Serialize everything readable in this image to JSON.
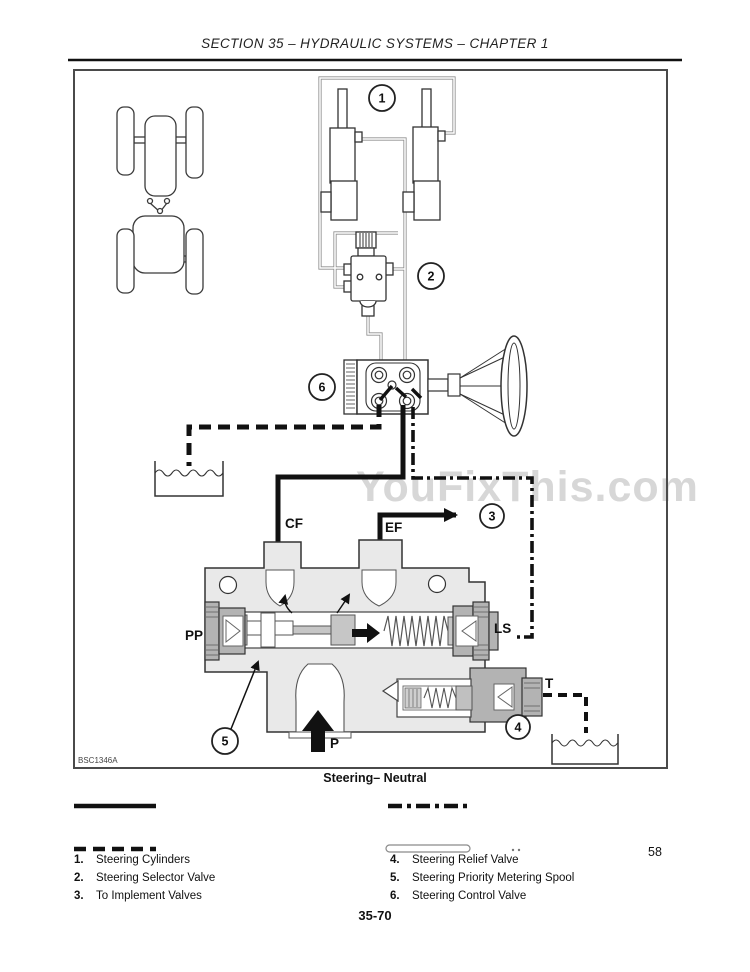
{
  "page": {
    "header_title": "SECTION 35 – HYDRAULIC SYSTEMS – CHAPTER 1",
    "watermark": "YouFixThis.com",
    "figure_code": "BSC1346A",
    "caption": "Steering– Neutral",
    "page_number_side": "58",
    "page_number_bottom": "35-70"
  },
  "diagram": {
    "port_labels": {
      "cf": "CF",
      "ef": "EF",
      "pp": "PP",
      "ls": "LS",
      "t": "T",
      "p": "P"
    },
    "callouts": {
      "c1": "1",
      "c2": "2",
      "c3": "3",
      "c4": "4",
      "c5": "5",
      "c6": "6"
    },
    "line_legend_styles": [
      "solid",
      "dash-dot",
      "dashed",
      "hollow"
    ]
  },
  "legend": {
    "left": [
      {
        "num": "1.",
        "label": "Steering Cylinders"
      },
      {
        "num": "2.",
        "label": "Steering Selector Valve"
      },
      {
        "num": "3.",
        "label": "To Implement Valves"
      }
    ],
    "right": [
      {
        "num": "4.",
        "label": "Steering Relief Valve"
      },
      {
        "num": "5.",
        "label": "Steering Priority Metering Spool"
      },
      {
        "num": "6.",
        "label": "Steering Control Valve"
      }
    ]
  },
  "colors": {
    "line": "#222222",
    "body_fill": "#e9e9e9",
    "fitting_fill": "#b3b3b3",
    "watermark": "#d7d7d7"
  }
}
